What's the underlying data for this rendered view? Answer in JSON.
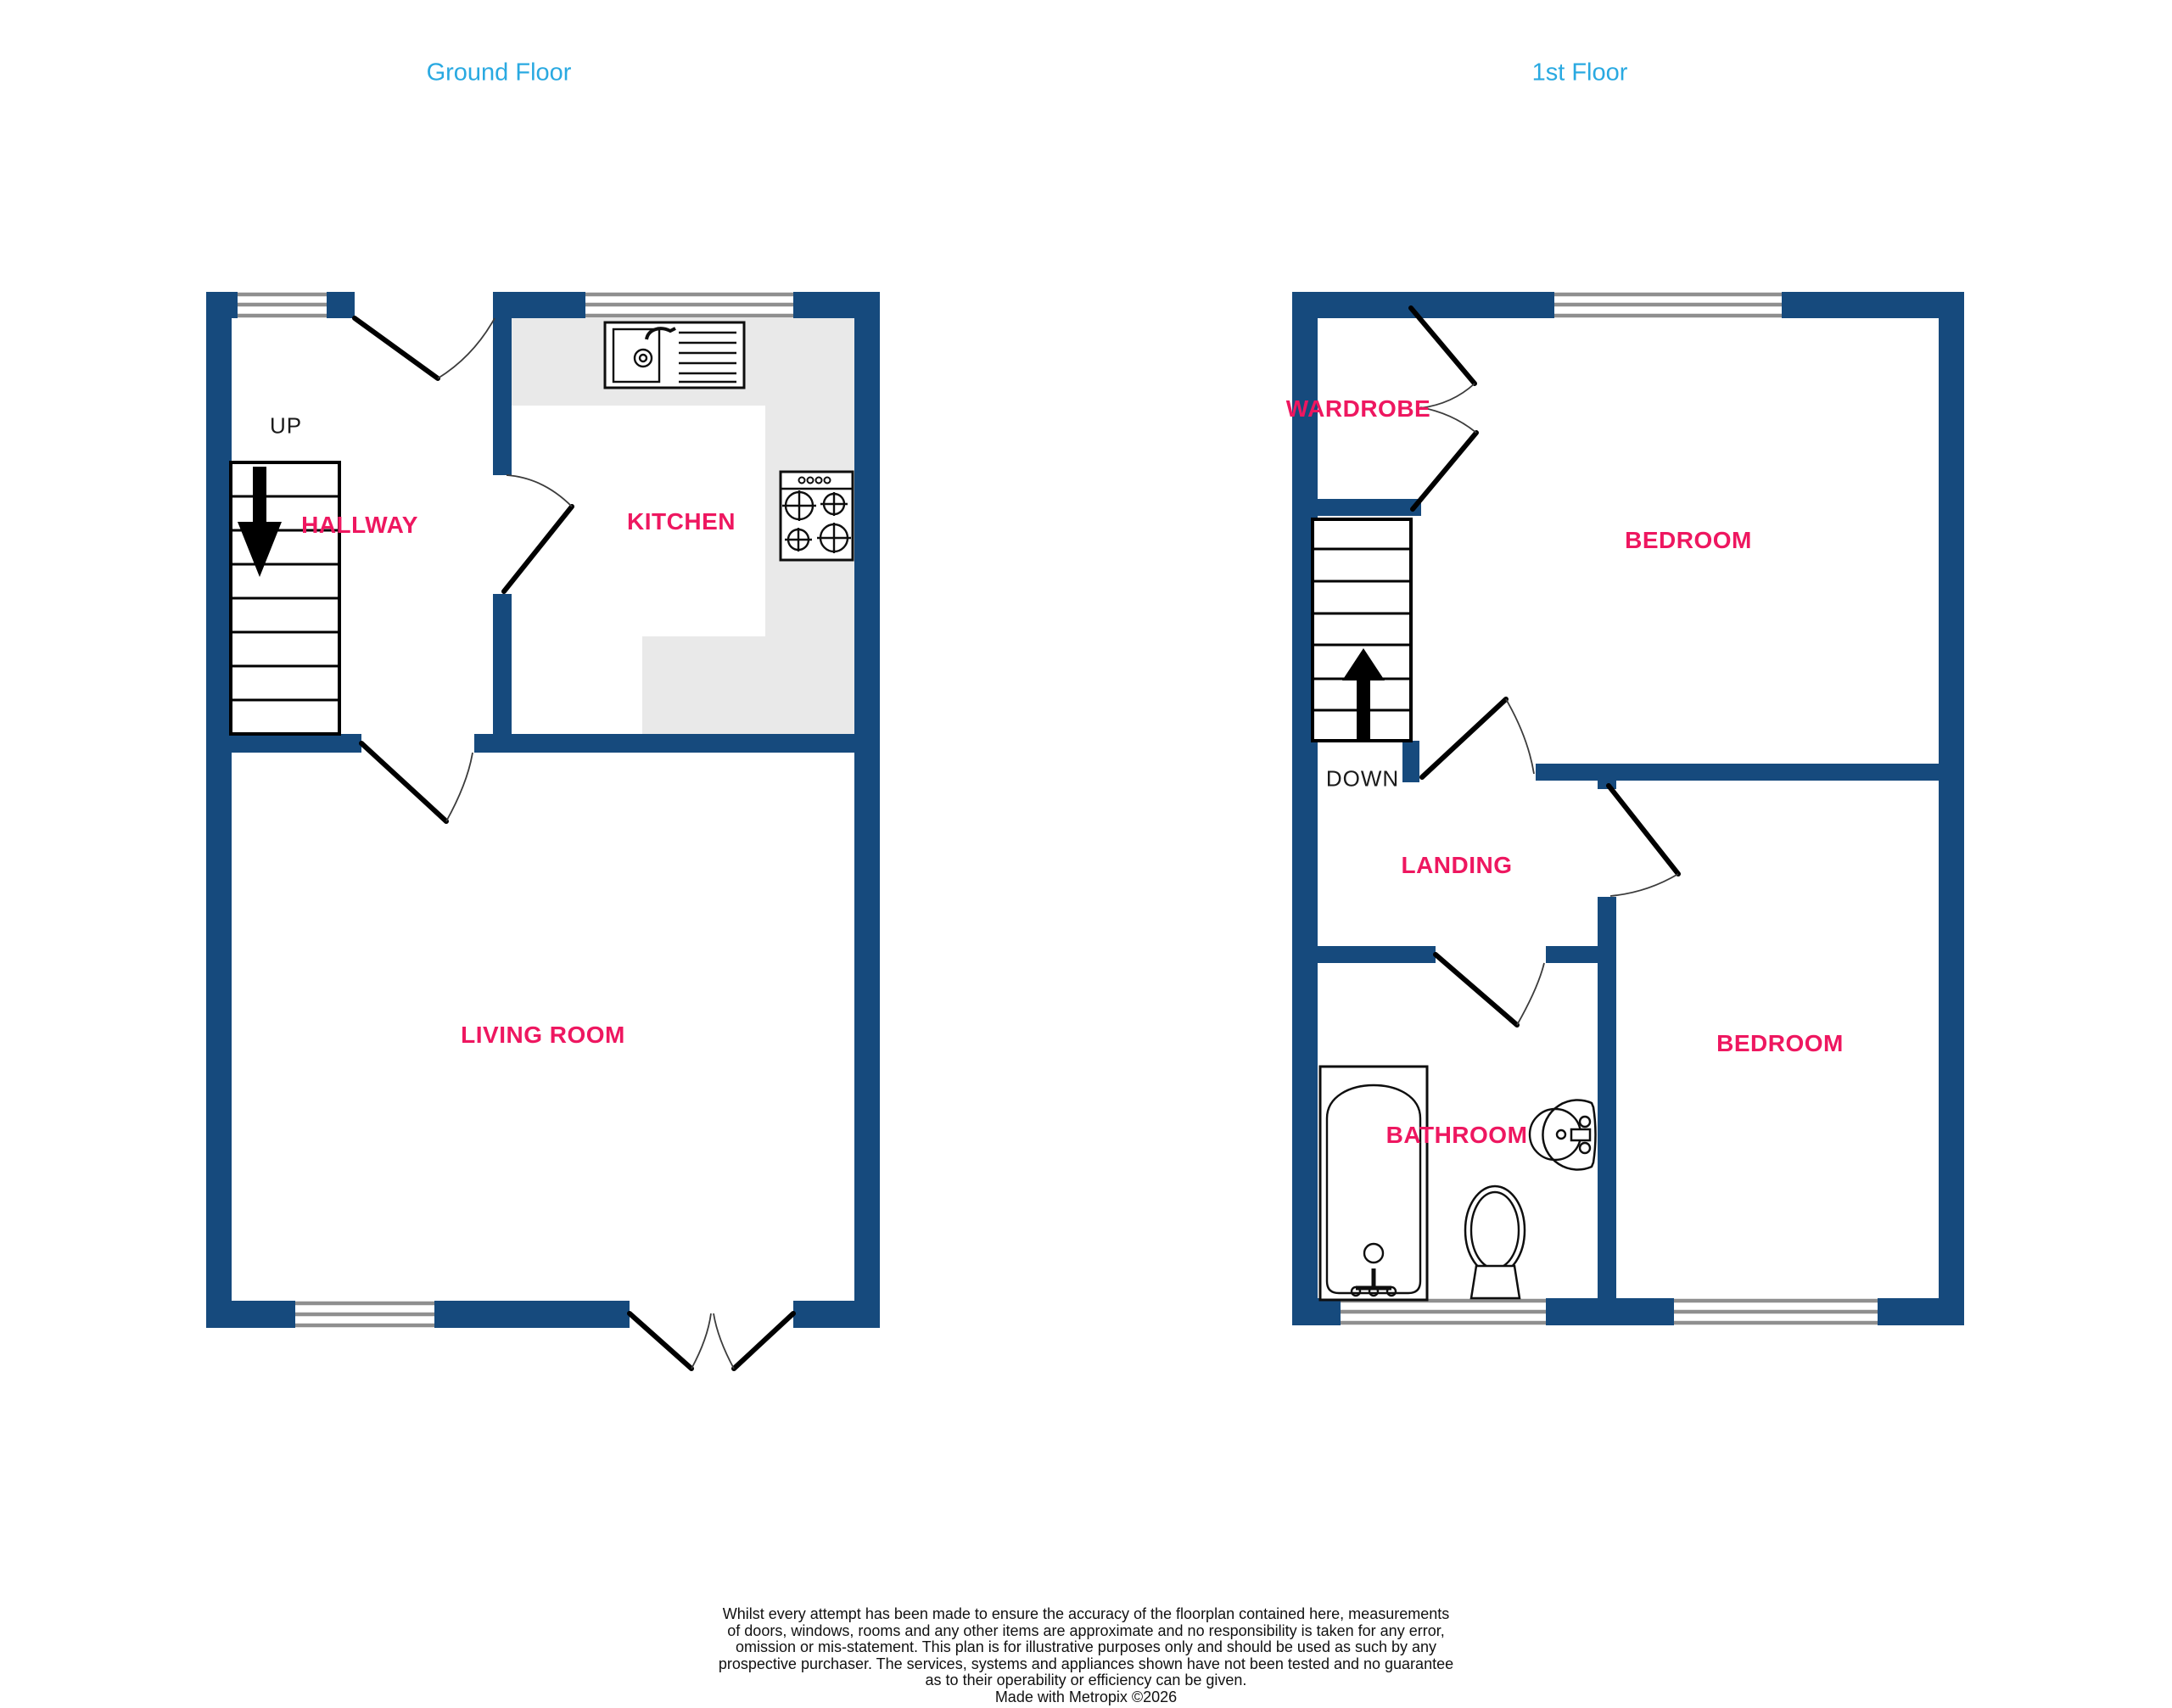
{
  "colors": {
    "wall": "#164A7D",
    "label": "#EE1760",
    "title": "#29A9E1",
    "counter": "#E9E9E9",
    "window_line": "#8F8F8F"
  },
  "ground_floor": {
    "title": "Ground Floor",
    "stairs_label": "UP",
    "rooms": {
      "hallway": "HALLWAY",
      "kitchen": "KITCHEN",
      "living_room": "LIVING ROOM"
    },
    "fixtures": [
      "kitchen-sink",
      "stove-hob",
      "staircase-up"
    ]
  },
  "first_floor": {
    "title": "1st Floor",
    "stairs_label": "DOWN",
    "rooms": {
      "wardrobe": "WARDROBE",
      "bedroom_front": "BEDROOM",
      "landing": "LANDING",
      "bathroom": "BATHROOM",
      "bedroom_rear": "BEDROOM"
    },
    "fixtures": [
      "bathtub",
      "toilet",
      "wash-basin",
      "staircase-down"
    ]
  },
  "disclaimer": {
    "lines": [
      "Whilst every attempt has been made to ensure the accuracy of the floorplan contained here, measurements",
      "of doors, windows, rooms and any other items are approximate and no responsibility is taken for any error,",
      "omission or mis-statement. This plan is for illustrative purposes only and should be used as such by any",
      "prospective purchaser. The services, systems and appliances shown have not been tested and no guarantee",
      "as to their operability or efficiency can be given."
    ],
    "credit": "Made with Metropix ©2026"
  }
}
